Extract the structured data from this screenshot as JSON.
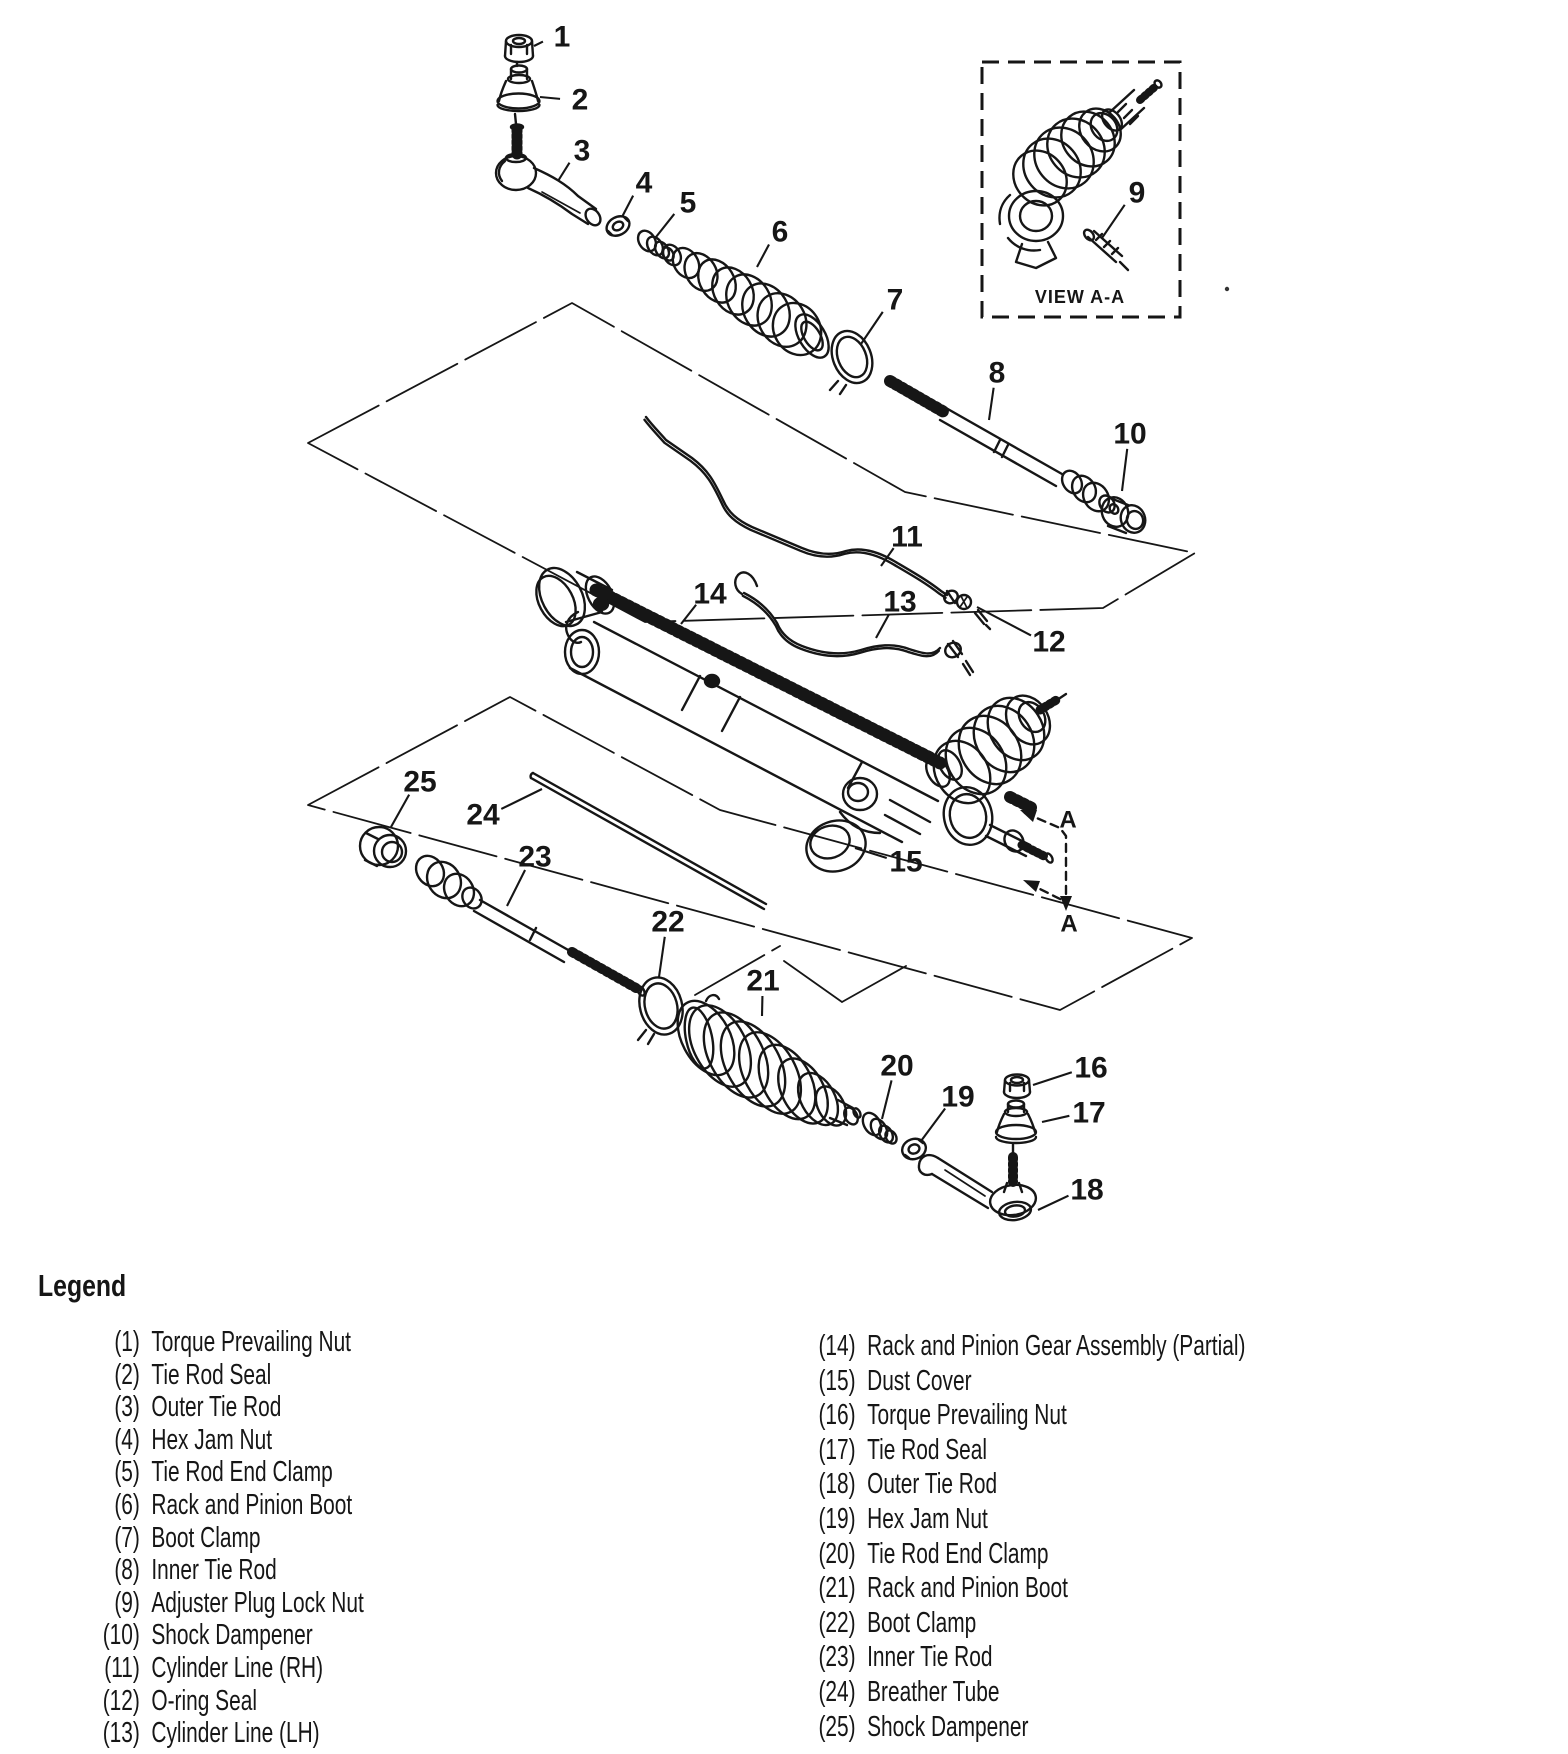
{
  "page": {
    "background": "#ffffff",
    "ink": "#161616"
  },
  "diagram": {
    "view_inset": {
      "label": "VIEW A-A"
    },
    "section_view": {
      "top_label": "A",
      "bottom_label": "A"
    },
    "callouts": [
      {
        "n": "1",
        "lx": 562,
        "ly": 37,
        "tx": 534,
        "ty": 46
      },
      {
        "n": "2",
        "lx": 580,
        "ly": 100,
        "tx": 540,
        "ty": 97
      },
      {
        "n": "3",
        "lx": 582,
        "ly": 151,
        "tx": 558,
        "ty": 181
      },
      {
        "n": "4",
        "lx": 644,
        "ly": 183,
        "tx": 622,
        "ty": 217
      },
      {
        "n": "5",
        "lx": 688,
        "ly": 203,
        "tx": 656,
        "ty": 237
      },
      {
        "n": "6",
        "lx": 780,
        "ly": 232,
        "tx": 757,
        "ty": 267
      },
      {
        "n": "7",
        "lx": 895,
        "ly": 300,
        "tx": 861,
        "ty": 344
      },
      {
        "n": "8",
        "lx": 997,
        "ly": 373,
        "tx": 989,
        "ty": 420
      },
      {
        "n": "9",
        "lx": 1137,
        "ly": 193,
        "tx": 1102,
        "ty": 238
      },
      {
        "n": "10",
        "lx": 1130,
        "ly": 434,
        "tx": 1122,
        "ty": 491
      },
      {
        "n": "11",
        "lx": 907,
        "ly": 537,
        "tx": 881,
        "ty": 566
      },
      {
        "n": "12",
        "lx": 1049,
        "ly": 642,
        "tx": 977,
        "ty": 607
      },
      {
        "n": "13",
        "lx": 900,
        "ly": 602,
        "tx": 876,
        "ty": 638
      },
      {
        "n": "14",
        "lx": 710,
        "ly": 594,
        "tx": 681,
        "ty": 624
      },
      {
        "n": "15",
        "lx": 906,
        "ly": 862,
        "tx": 855,
        "ty": 848
      },
      {
        "n": "16",
        "lx": 1091,
        "ly": 1068,
        "tx": 1033,
        "ty": 1085
      },
      {
        "n": "17",
        "lx": 1089,
        "ly": 1113,
        "tx": 1042,
        "ty": 1122
      },
      {
        "n": "18",
        "lx": 1087,
        "ly": 1190,
        "tx": 1038,
        "ty": 1210
      },
      {
        "n": "19",
        "lx": 958,
        "ly": 1097,
        "tx": 921,
        "ty": 1141
      },
      {
        "n": "20",
        "lx": 897,
        "ly": 1066,
        "tx": 882,
        "ty": 1119
      },
      {
        "n": "21",
        "lx": 763,
        "ly": 981,
        "tx": 762,
        "ty": 1016
      },
      {
        "n": "22",
        "lx": 668,
        "ly": 922,
        "tx": 659,
        "ty": 977
      },
      {
        "n": "23",
        "lx": 535,
        "ly": 857,
        "tx": 507,
        "ty": 906
      },
      {
        "n": "24",
        "lx": 483,
        "ly": 815,
        "tx": 542,
        "ty": 789
      },
      {
        "n": "25",
        "lx": 420,
        "ly": 782,
        "tx": 391,
        "ty": 827
      }
    ]
  },
  "legend": {
    "title": "Legend",
    "left_column": [
      {
        "num": "(1)",
        "label": "Torque Prevailing Nut"
      },
      {
        "num": "(2)",
        "label": "Tie Rod Seal"
      },
      {
        "num": "(3)",
        "label": "Outer Tie Rod"
      },
      {
        "num": "(4)",
        "label": "Hex Jam Nut"
      },
      {
        "num": "(5)",
        "label": "Tie Rod End Clamp"
      },
      {
        "num": "(6)",
        "label": "Rack and Pinion Boot"
      },
      {
        "num": "(7)",
        "label": "Boot Clamp"
      },
      {
        "num": "(8)",
        "label": "Inner Tie Rod"
      },
      {
        "num": "(9)",
        "label": "Adjuster Plug Lock Nut"
      },
      {
        "num": "(10)",
        "label": "Shock Dampener"
      },
      {
        "num": "(11)",
        "label": "Cylinder Line (RH)"
      },
      {
        "num": "(12)",
        "label": "O-ring Seal"
      },
      {
        "num": "(13)",
        "label": "Cylinder Line (LH)"
      }
    ],
    "right_column": [
      {
        "num": "(14)",
        "label": "Rack and Pinion Gear Assembly (Partial)"
      },
      {
        "num": "(15)",
        "label": "Dust Cover"
      },
      {
        "num": "(16)",
        "label": "Torque Prevailing Nut"
      },
      {
        "num": "(17)",
        "label": "Tie Rod Seal"
      },
      {
        "num": "(18)",
        "label": "Outer Tie Rod"
      },
      {
        "num": "(19)",
        "label": "Hex Jam Nut"
      },
      {
        "num": "(20)",
        "label": "Tie Rod End Clamp"
      },
      {
        "num": "(21)",
        "label": "Rack and Pinion Boot"
      },
      {
        "num": "(22)",
        "label": "Boot Clamp"
      },
      {
        "num": "(23)",
        "label": "Inner Tie Rod"
      },
      {
        "num": "(24)",
        "label": "Breather Tube"
      },
      {
        "num": "(25)",
        "label": "Shock Dampener"
      }
    ]
  }
}
